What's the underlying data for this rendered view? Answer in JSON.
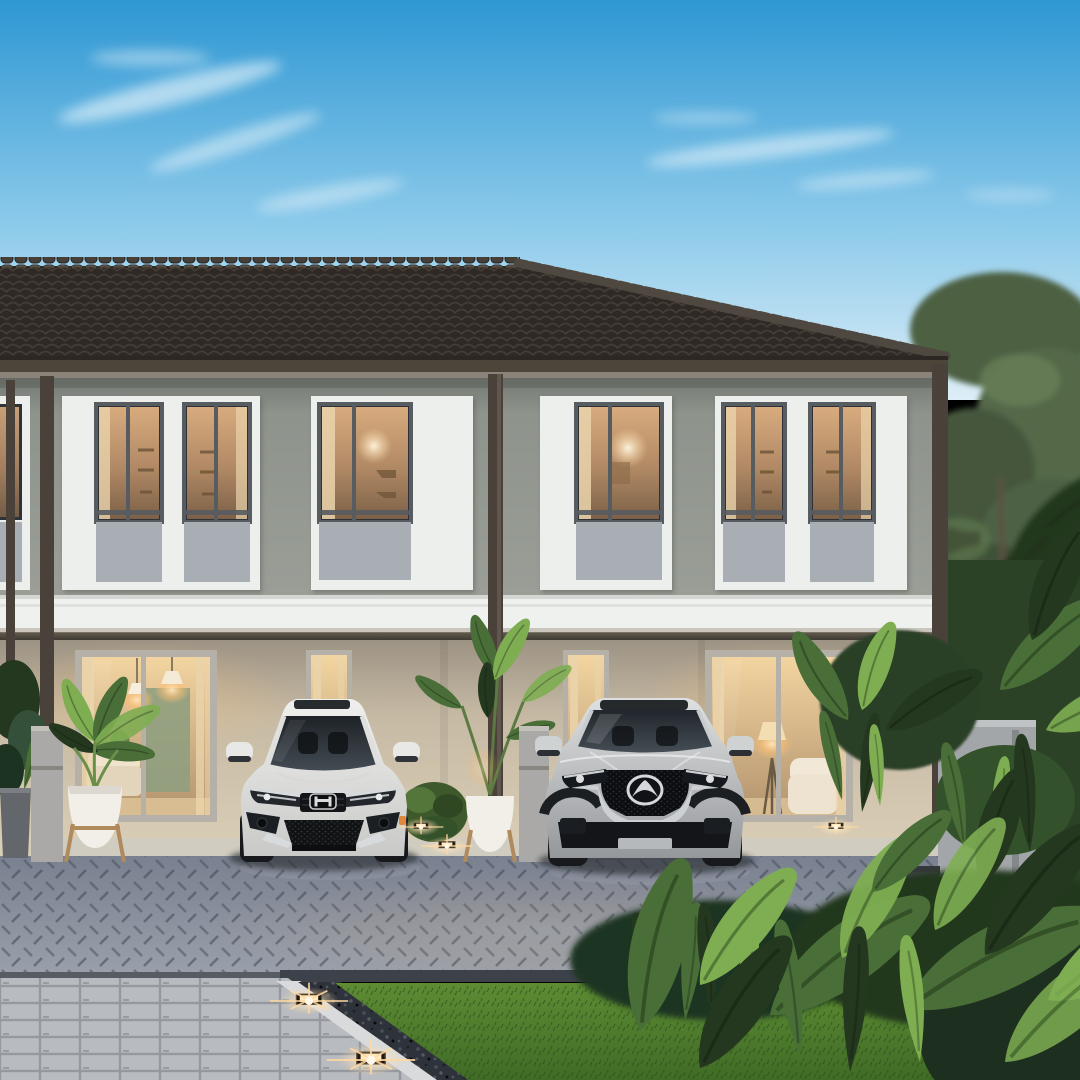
{
  "image": {
    "type": "3d-architectural-rendering",
    "subject": "Modern two-storey townhouse row at dusk with two cars parked in front carports, tropical landscaping and paver driveway",
    "time_of_day": "dusk"
  },
  "sky": {
    "top": "#2e97d3",
    "mid": "#8ac9ea",
    "horizon": "#ddeef7",
    "clouds": "#ffffff"
  },
  "roof": {
    "tile": "#2e2924",
    "tile_highlight": "#4a433b",
    "ridge": "#453f38",
    "hip": "#4f4840",
    "fascia": "#4d443a",
    "fascia_lip": "#8a8379"
  },
  "building": {
    "storeys": 2,
    "units_fully_visible": 2,
    "facade_upper": "#8e938c",
    "facade_upper_shadow": "#747973",
    "facade_upper_light": "#9a9e97",
    "floor_band": "#eff1ef",
    "band_lip": "#cbc6bd",
    "window_frame": "#edefed",
    "window_sash": "#565b60",
    "window_glass": "#d8ab7e",
    "glass_mid": "#b08864",
    "glass_deep": "#7c6148",
    "glass_dark": "#2e3338",
    "spandrel": "#a9aeb5",
    "curtain": "#ead3ab",
    "carport_wall": "#c6baa4",
    "carport_wall_shadow": "#9d9384",
    "carport_wall_light": "#dbcfb8",
    "carport_floor": "#d0ccc0",
    "interior_glow": "#f3d5a1",
    "interior_deep": "#b2936e",
    "soffit": "#6f6758",
    "door_frame": "#b5b1a9",
    "accent_wall": "#8f9e80",
    "post": "#4a423a"
  },
  "vehicles": [
    {
      "name": "white hatchback",
      "badge": "honda-h-logo",
      "body": "#efefed",
      "body_shade": "#c9cac8",
      "glass": "#1d2226",
      "grille": "#121417",
      "chrome": "#d8dbdd"
    },
    {
      "name": "silver suv",
      "badge": "mazda-wing-logo",
      "body": "#dfe0e1",
      "body_shade": "#95989b",
      "glass": "#20262b",
      "grille": "#0b0d10",
      "chrome": "#cdd0d2"
    }
  ],
  "landscape": {
    "driveway": "#79808f",
    "driveway_light": "#9ba1ab",
    "walkway": "#b4b7bc",
    "walkway_edge": "#d9dadb",
    "gravel": "#2e323a",
    "curb": "#3c414a",
    "lawn": "#5e8c33",
    "lawn_dark": "#3f6b26",
    "foliage_dark": "#24371f",
    "foliage_mid": "#4a6e38",
    "foliage_light": "#7fae52",
    "hedge": "#3e5a2c",
    "tree": "#4d6143",
    "planter_white": "#f2efe8",
    "planter_dark": "#63676b",
    "stand_wood": "#b08a5c",
    "pillar": "#aaa9a7",
    "pillar_right": "#a3a6a8",
    "bollard": "#3f4346",
    "bollard_light": "#f6c887",
    "ground_light": "#ffbe72"
  }
}
